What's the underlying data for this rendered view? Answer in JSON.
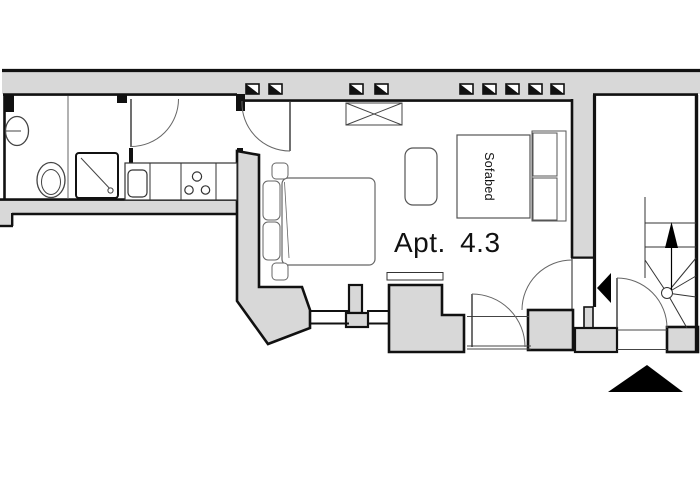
{
  "plan": {
    "apartment_label": "Apt. 4.3",
    "sofabed_label": "Sofabed",
    "colors": {
      "background": "#ffffff",
      "wall_fill": "#d8d8d8",
      "wall_outline": "#111111",
      "furniture_line": "#555555",
      "door_line": "#444444",
      "marker_black": "#000000"
    },
    "icons": [
      "window-vent-icon",
      "stairs-up-arrow-icon",
      "apartment-entrance-arrow-icon",
      "building-entrance-arrow-icon"
    ]
  }
}
